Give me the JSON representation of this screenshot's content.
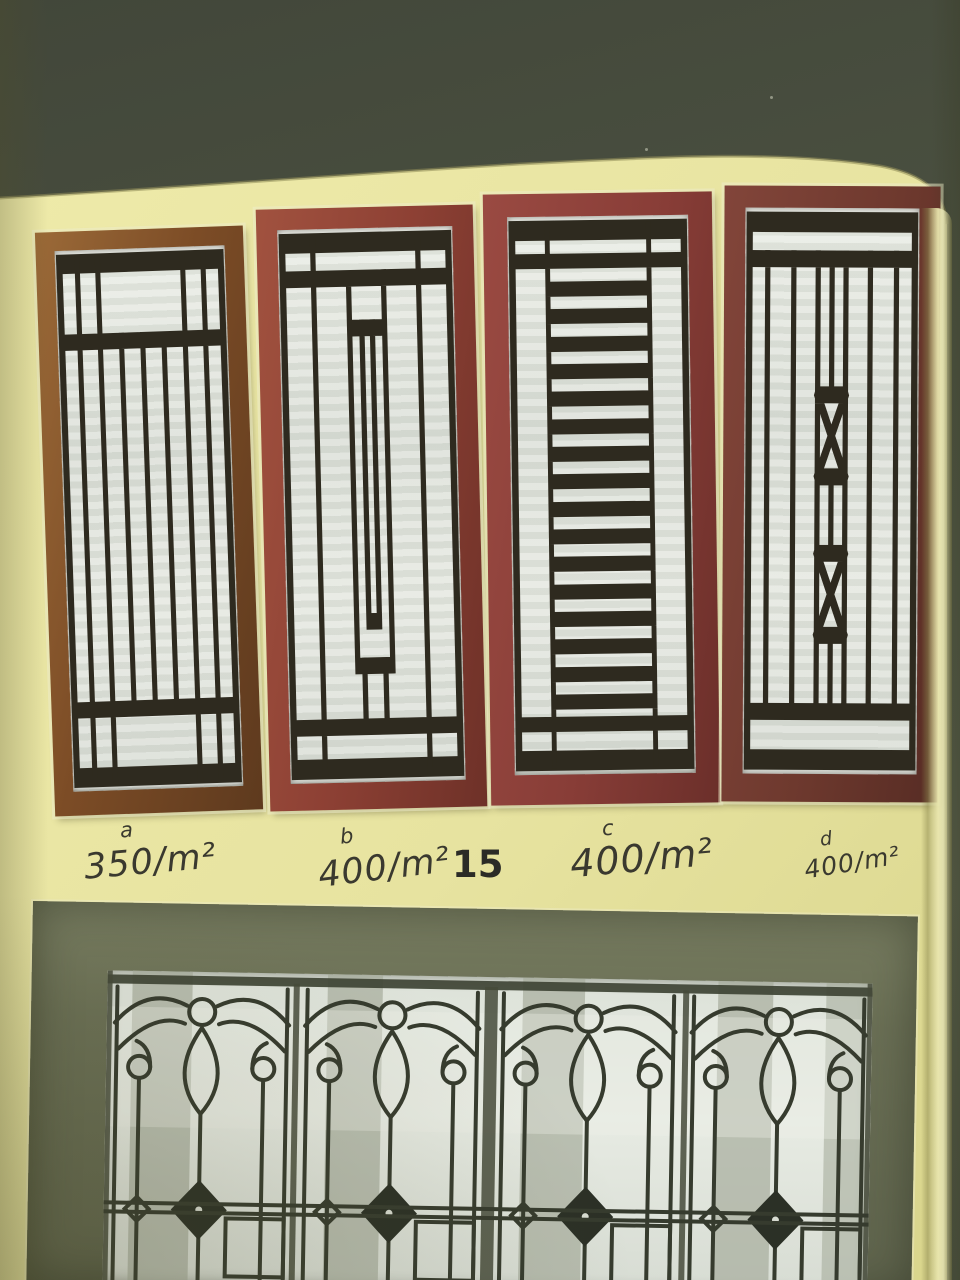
{
  "scene": {
    "type": "photograph of a window-grille catalog booklet page",
    "wall_color": "#4d5342",
    "page_color": "#e9e5a2",
    "iron_color": "#363b2e"
  },
  "page": {
    "page_number": "15",
    "items": [
      {
        "label": "a",
        "price": "350/m²",
        "frame_color": "#7c4c26",
        "grille_style": "vertical-bars"
      },
      {
        "label": "b",
        "price": "400/m²",
        "frame_color": "#8d4034",
        "grille_style": "stepped-center-column"
      },
      {
        "label": "c",
        "price": "400/m²",
        "frame_color": "#883d37",
        "grille_style": "horizontal-ladder"
      },
      {
        "label": "d",
        "price": "400/m²",
        "frame_color": "#6e392e",
        "grille_style": "double-x-boxes"
      }
    ],
    "bottom_photo": {
      "subject": "ornamental wrought-iron scroll window grilles"
    }
  }
}
